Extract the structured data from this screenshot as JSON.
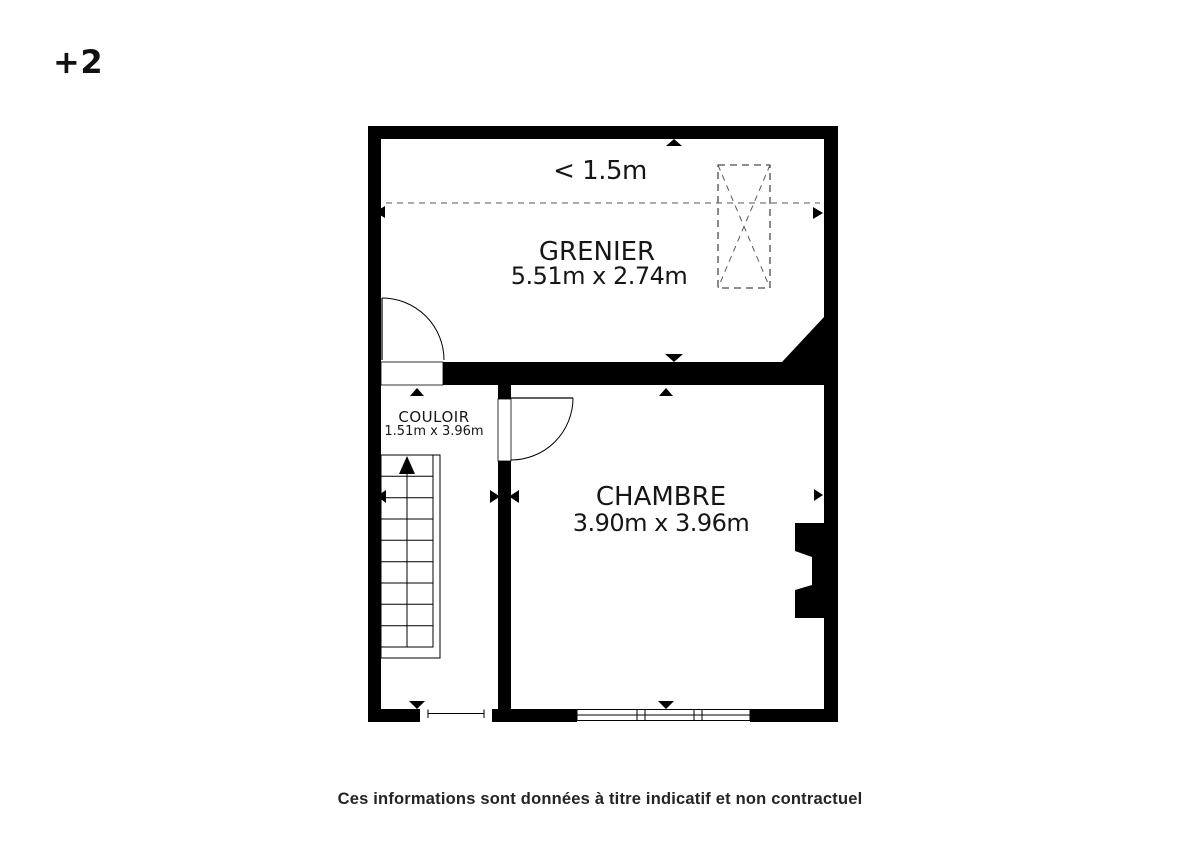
{
  "page": {
    "floor_label": "+2",
    "disclaimer": "Ces informations sont données à titre indicatif et non contractuel"
  },
  "plan": {
    "height_annotation": "< 1.5m",
    "rooms": {
      "grenier": {
        "name": "GRENIER",
        "dimensions": "5.51m x 2.74m"
      },
      "couloir": {
        "name": "COULOIR",
        "dimensions": "1.51m x 3.96m"
      },
      "chambre": {
        "name": "CHAMBRE",
        "dimensions": "3.90m x 3.96m"
      }
    },
    "symbols": {
      "roof_window": "dashed-rect-with-x",
      "staircase": "treads-with-up-arrow",
      "door": "quarter-circle-swing-arc",
      "chimney": "black-block-with-notch",
      "dimension_marker": "small-black-triangle"
    },
    "colors": {
      "walls": "#000000",
      "background": "#ffffff",
      "dashed_line": "#8f8f8f",
      "text": "#1a1a1a"
    }
  }
}
